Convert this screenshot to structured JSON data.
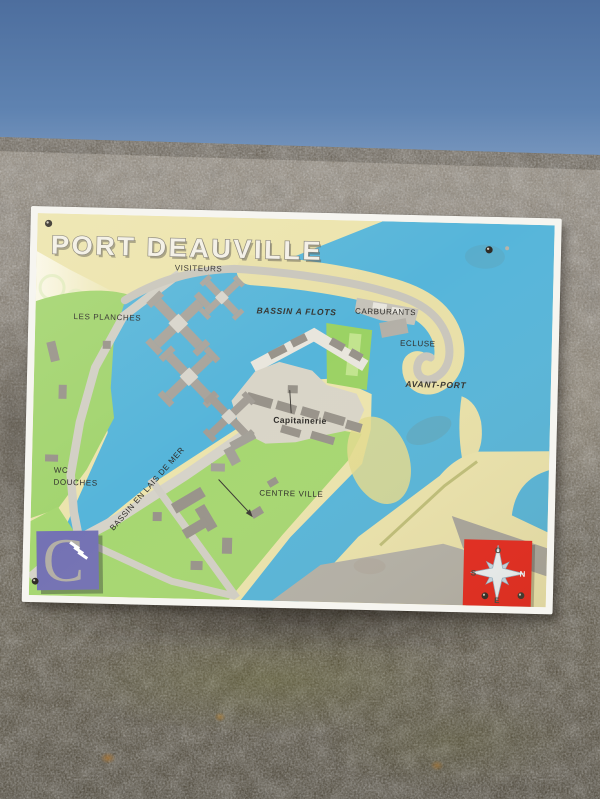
{
  "sign": {
    "title": "PORT DEAUVILLE",
    "labels": {
      "visiteurs": "VISITEURS",
      "les_planches": "LES PLANCHES",
      "bassin_a_flots": "BASSIN A FLOTS",
      "carburants": "CARBURANTS",
      "ecluse": "ECLUSE",
      "avant_port": "AVANT-PORT",
      "capitainerie": "Capitainerie",
      "wc": "WC",
      "douches": "DOUCHES",
      "bassin_en_lais_de_mer": "BASSIN EN LAIS DE MER",
      "centre_ville": "CENTRE VILLE"
    },
    "compass": {
      "north": "N",
      "south": "S",
      "east": "E",
      "west": "O"
    },
    "logo_letter": "C",
    "colors": {
      "water": "#56b5da",
      "sand": "#ece4ad",
      "green": "#a2d46f",
      "compass_red": "#e6271d",
      "logo_purple": "#7472b4"
    }
  }
}
